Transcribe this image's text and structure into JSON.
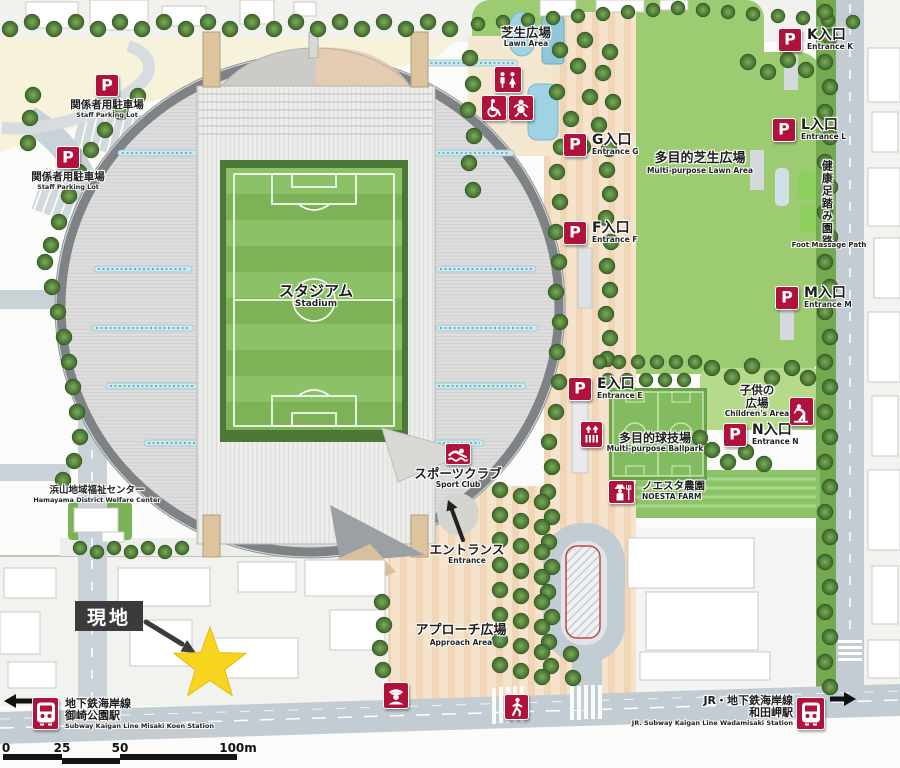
{
  "p_symbol": "P",
  "stadium": {
    "jp": "スタジアム",
    "en": "Stadium"
  },
  "entrances": [
    {
      "id": "k",
      "jp": "K入口",
      "en": "Entrance K"
    },
    {
      "id": "l",
      "jp": "L入口",
      "en": "Entrance L"
    },
    {
      "id": "g",
      "jp": "G入口",
      "en": "Entrance G"
    },
    {
      "id": "f",
      "jp": "F入口",
      "en": "Entrance F"
    },
    {
      "id": "m",
      "jp": "M入口",
      "en": "Entrance M"
    },
    {
      "id": "e",
      "jp": "E入口",
      "en": "Entrance E"
    },
    {
      "id": "n",
      "jp": "N入口",
      "en": "Entrance N"
    }
  ],
  "staff_parking": {
    "jp": "関係者用駐車場",
    "en": "Staff Parking Lot"
  },
  "facilities": {
    "lawn_area": {
      "jp": "芝生広場",
      "en": "Lawn Area"
    },
    "multipurpose_lawn": {
      "jp": "多目的芝生広場",
      "en": "Multi-purpose Lawn Area"
    },
    "foot_massage_path": {
      "jp": "健康足踏み園路",
      "en": "Foot Massage Path"
    },
    "childrens_area": {
      "jp1": "子供の",
      "jp2": "広場",
      "en": "Children's Area"
    },
    "multipurpose_ballpark": {
      "jp": "多目的球技場",
      "en": "Multi-purpose Ballpark"
    },
    "noesta_farm": {
      "jp": "ノエスタ農園",
      "en": "NOESTA FARM"
    },
    "sport_club": {
      "jp": "スポーツクラブ",
      "en": "Sport Club"
    },
    "entrance": {
      "jp": "エントランス",
      "en": "Entrance"
    },
    "approach_area": {
      "jp": "アプローチ広場",
      "en": "Approach Area"
    },
    "welfare_center": {
      "jp": "浜山地域福祉センター",
      "en": "Hamayama District Welfare Center"
    }
  },
  "site_marker": {
    "label": "現地"
  },
  "stations": {
    "misaki": {
      "line": "地下鉄海岸線",
      "station": "御崎公園駅",
      "en": "Subway Kaigan Line Misaki Koen Station"
    },
    "wadamisaki": {
      "line": "JR・地下鉄海岸線",
      "station": "和田岬駅",
      "en": "JR. Subway Kaigan Line Wadamisaki Station"
    }
  },
  "scale_bar": {
    "ticks": [
      "0",
      "25",
      "50",
      "100m"
    ]
  },
  "icons": {
    "parking": "P-icon",
    "restroom": "restroom-icon",
    "wheelchair": "accessible-icon",
    "baby": "baby-room-icon",
    "elevator": "elevator-icon",
    "fountain": "drinking-fountain-icon",
    "farmer": "farm-icon",
    "swimmer": "swimming-icon",
    "police": "police-box-icon",
    "pedestrian": "pedestrian-crossing-icon",
    "train": "station-icon",
    "star": "site-star-marker"
  },
  "colors": {
    "accent_red": "#b0123b",
    "star_yellow": "#f7d51e",
    "lawn_green": "#9ccb72",
    "pitch_green": "#86bb60",
    "path_cream": "#f5e1c8",
    "road_grey": "#c3ccd3",
    "marker_black": "#3b3b3b"
  }
}
